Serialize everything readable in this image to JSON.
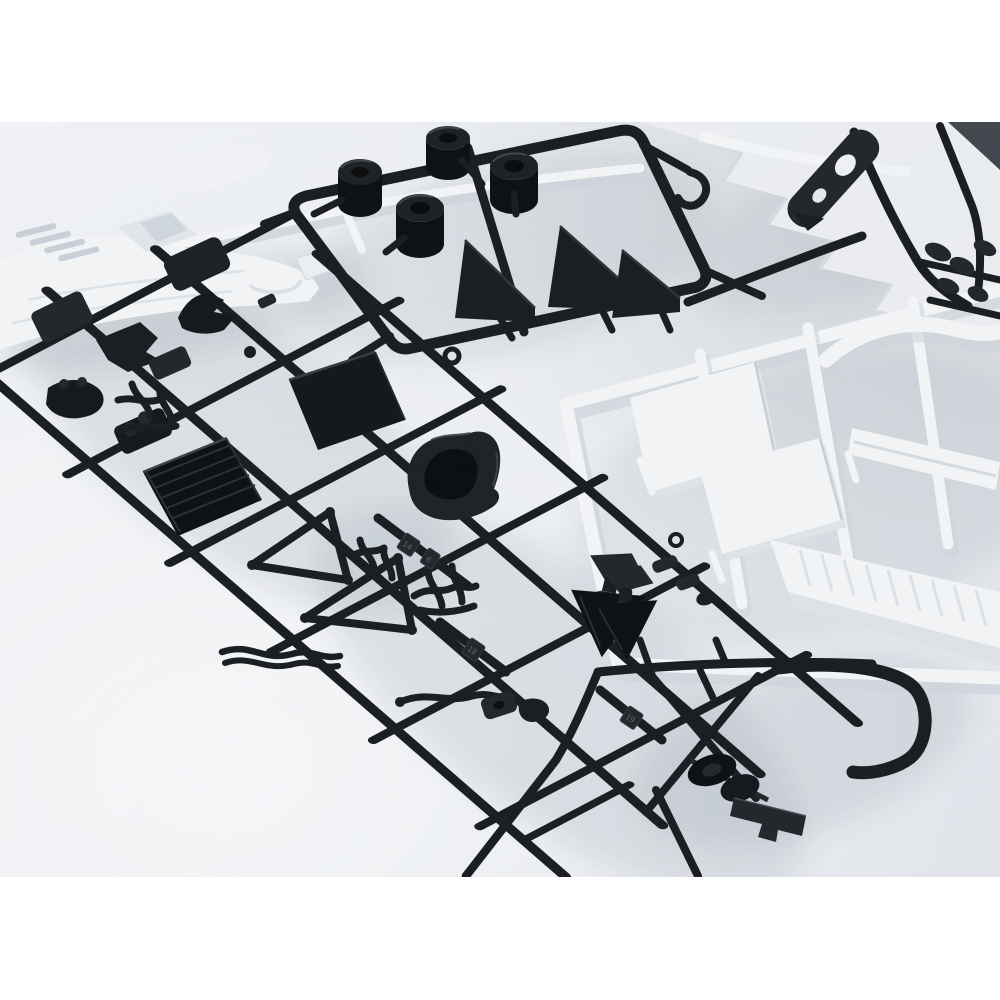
{
  "meta": {
    "media_type": "photograph",
    "description": "Overhead angled close-up photo of injection-molded plastic model car kit sprues (parts trees) laid on a bright white surface, framed by white margins at top and bottom.",
    "photo_area": {
      "top_px": 122,
      "bottom_px": 877,
      "width_px": 1000
    }
  },
  "scene": {
    "surface": "bright white studio table",
    "lighting": "soft diffuse daylight with gentle shadows falling down-right of parts",
    "no_ui_text_visible": true
  },
  "sprues": {
    "body_shell_sprue": {
      "color_name": "white",
      "position": "top left",
      "parts": [
        "low wedge race-car body shell",
        "louvered nose vents",
        "cockpit canopy recess",
        "long white runner rail"
      ]
    },
    "tire_sprue": {
      "color_name": "black",
      "position": "top center",
      "parts": [
        "four cylindrical slick tires",
        "three wedge-shaped diffuser fins",
        "rectangular runner frame"
      ]
    },
    "suspension_sprue": {
      "color_name": "black",
      "position": "top right",
      "parts": [
        "flat arm with two lightening holes",
        "diagonal runners",
        "small linkage lumps"
      ],
      "background": "out-of-focus white sprue with stepped parts"
    },
    "interior_panel_sprue": {
      "color_name": "white",
      "position": "middle right",
      "parts": [
        "two flat seat/floor panels",
        "thin sill strip",
        "long ribbed rocker panel",
        "curved S strap",
        "runner frame"
      ]
    },
    "chassis_sprue": {
      "color_name": "black",
      "position": "diagonal across center foreground",
      "parts": [
        "lattice of runners",
        "ribbed radiator panel",
        "smooth roof plate",
        "bucket seat",
        "two A-arm wishbones",
        "exhaust manifold branches",
        "two suspension uprights with brake cones",
        "steering knuckles",
        "wavy pipes",
        "assorted small brackets"
      ],
      "molded_number_tags_visible": true
    },
    "frame_sprue": {
      "color_name": "black",
      "position": "bottom right",
      "parts": [
        "side frame with crossed braces",
        "roll-over hoop hook",
        "gear and axle cluster",
        "notched mounting bar"
      ]
    }
  },
  "tags": {
    "t1": "14",
    "t2": "6",
    "t3": "18",
    "t4": "19"
  },
  "colors": {
    "page_background": "#ffffff",
    "surface_light": "#f1f3f6",
    "surface_mid": "#e9ecf0",
    "surface_dark": "#e1e5eb",
    "black_plastic": "#1a1d21",
    "black_plastic_deep": "#0e1114",
    "black_plastic_sheen": "#23272c",
    "white_plastic": "#f2f4f6",
    "white_plastic_shadow": "#cdd4db",
    "soft_shadow": "#7d8896"
  }
}
